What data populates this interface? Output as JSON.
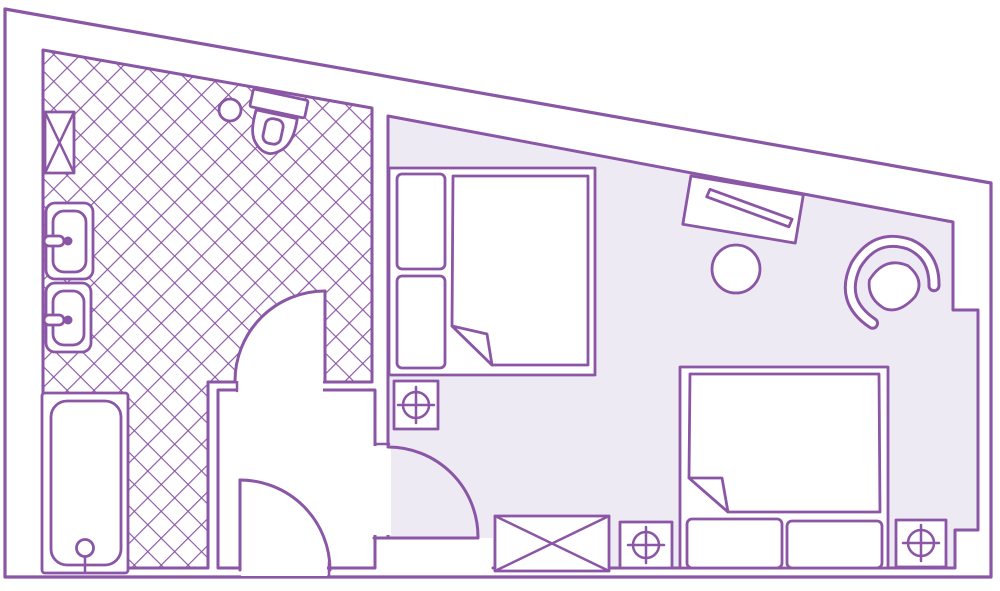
{
  "app": {
    "type": "floor-plan",
    "description": "hand-drawn style hotel room floor plan, purple line art"
  },
  "colors": {
    "line": "#8a56a5",
    "bedroom_floor": "#edeaf4",
    "wall_fill": "#ffffff",
    "page_background": "#ffffff"
  },
  "rooms": [
    {
      "name": "bathroom",
      "floor_pattern": "diagonal-crosshatch-tile",
      "fixtures": [
        "wall-shelf-x-box",
        "toilet",
        "toilet-roll",
        "sink-upper",
        "sink-lower",
        "bathtub-with-drain"
      ]
    },
    {
      "name": "entry-vestibule",
      "floor_pattern": "plain-white"
    },
    {
      "name": "bedroom",
      "floor_pattern": "solid-lavender-carpet",
      "furniture": [
        "double-bed-upper",
        "double-bed-lower",
        "luggage-rack-x",
        "light-fixture-symbol-1",
        "light-fixture-symbol-2",
        "light-fixture-symbol-3",
        "desk",
        "round-stool",
        "armchair"
      ]
    }
  ],
  "doors": [
    {
      "name": "entry-door",
      "location": "bottom-wall",
      "swing": "into-vestibule"
    },
    {
      "name": "bathroom-door",
      "location": "vestibule-to-bathroom",
      "swing": "into-bathroom"
    },
    {
      "name": "bedroom-door",
      "location": "vestibule-to-bedroom",
      "swing": "into-bedroom"
    }
  ]
}
